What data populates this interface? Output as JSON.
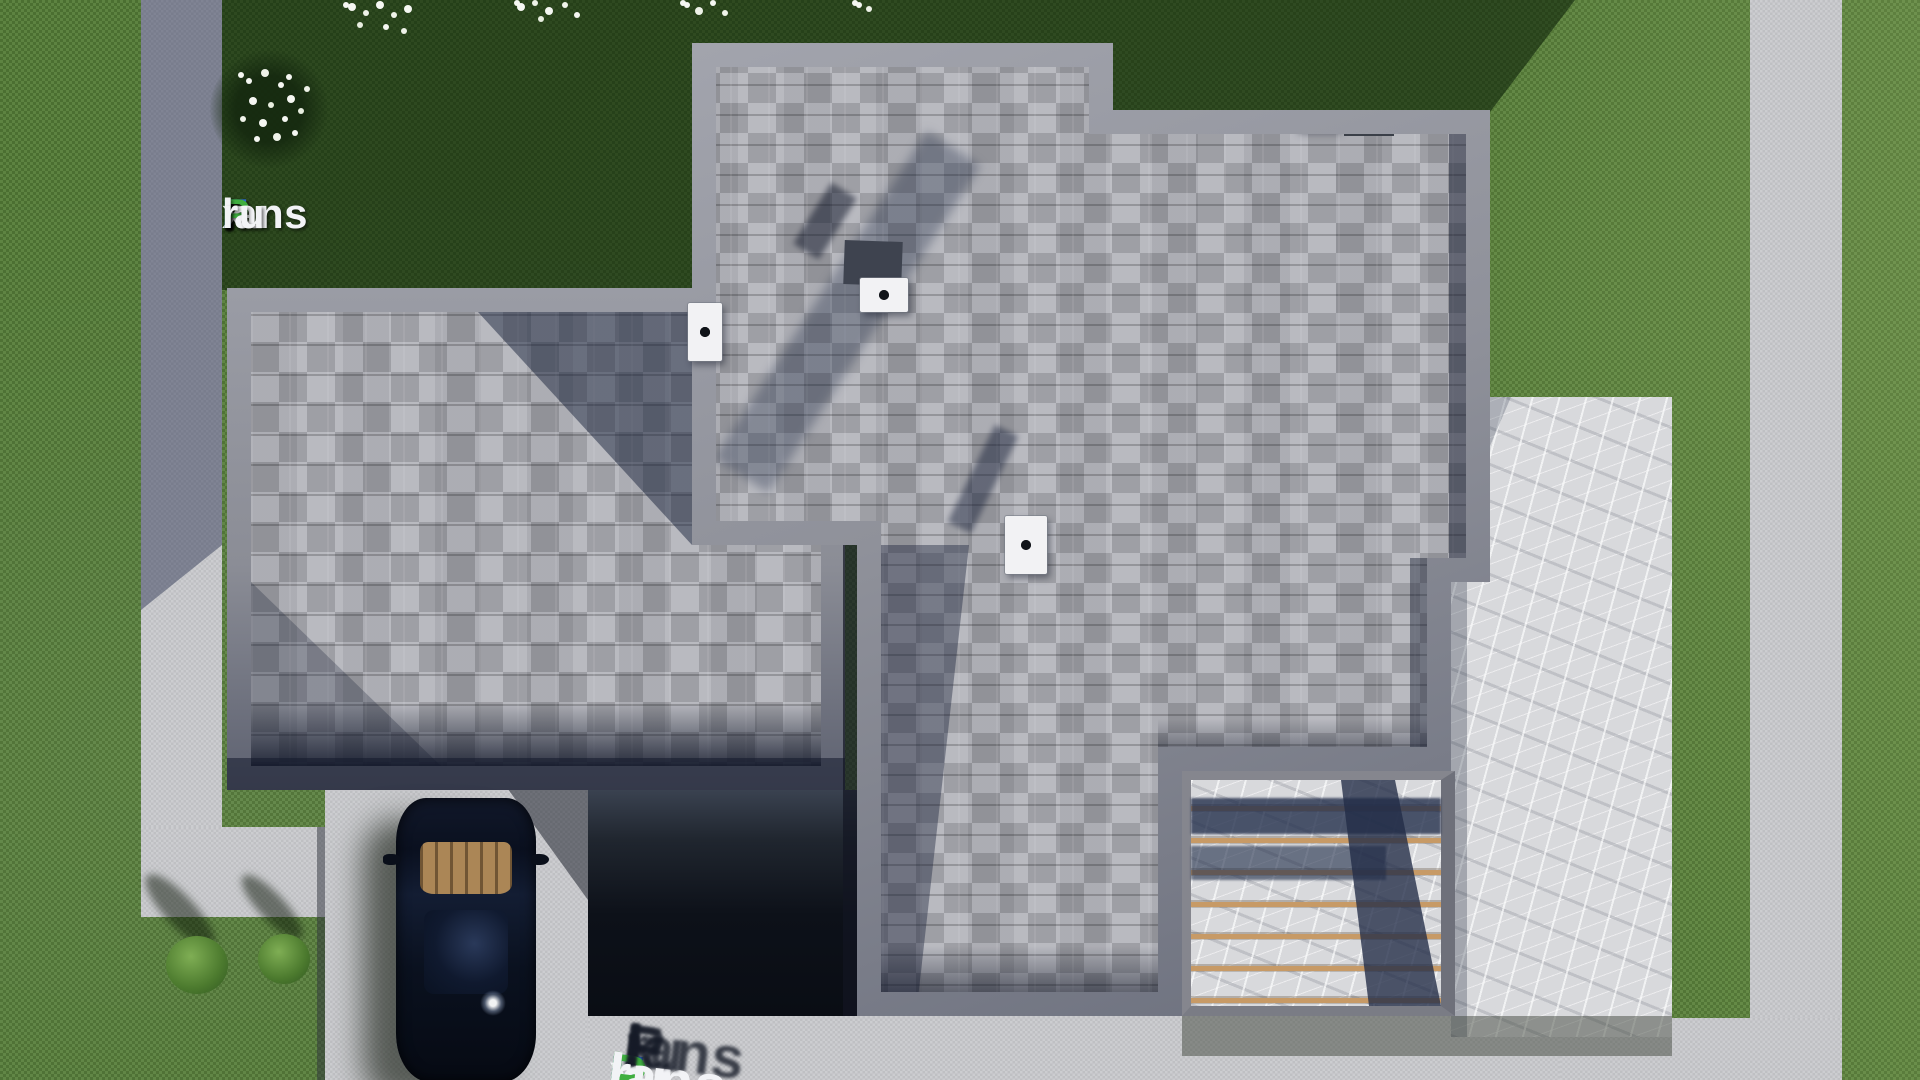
{
  "scene_description": "Top-down 3D architectural render of a single-family house: gray asphalt-shingle roof with vents and chimneys, lawn, concrete walkways, driveway with parked dark car, marble terrace with wooden pergola slats",
  "brand": {
    "text": "FixPlans.ru",
    "letters": [
      {
        "char": "F",
        "color": "#2e6fe2"
      },
      {
        "char": "i",
        "color": "#3fae3f"
      },
      {
        "char": "x",
        "color": "#f2f3f6"
      },
      {
        "char": "P",
        "color": "#3fae3f"
      },
      {
        "char": "lans",
        "color": "#f2f3f6"
      },
      {
        "char": ".",
        "color": "#2e6fe2"
      },
      {
        "char": "ru",
        "color": "#f2f3f6"
      }
    ]
  },
  "bottom_watermark": {
    "text": "FixPlans.ru"
  },
  "palette": {
    "grass": "#547c37",
    "grass_shadow": "#1e3413",
    "roof_shingles": "#aeafb6",
    "roof_fascia": "#8e9099",
    "concrete_path": "#c9cacd",
    "marble_terrace": "#d8d9dc",
    "pergola_wood": "#c79a66",
    "shadow_blue": "#2a3a5e",
    "car_body": "#0c1322",
    "car_dash_wood": "#ab8656",
    "vent_box": "#f2f2f4"
  }
}
